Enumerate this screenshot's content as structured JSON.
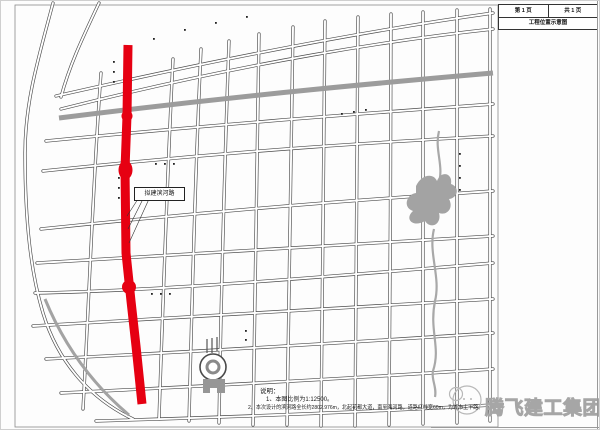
{
  "title_block": {
    "page_cell": "第 1 页",
    "total_cell": "共 1 页",
    "title_cell": "工程位置示意图"
  },
  "map": {
    "proposed_road_label": "拟建滨河路",
    "notes": {
      "heading": "说明：",
      "line1": "1、本图比例为1:12500。",
      "line2": "2、本次设计的滨河路全长约2802.976m，北起花都大道，南至海河路，道路红线宽60m，为城市主干路。"
    }
  },
  "watermark": {
    "company_name": "腾飞建工集团"
  },
  "colors": {
    "road_red": "#e60012",
    "street_line": "#4a4a4a",
    "water_gray": "#a3a3a3",
    "watermark_gray": "#a6a6a6"
  }
}
